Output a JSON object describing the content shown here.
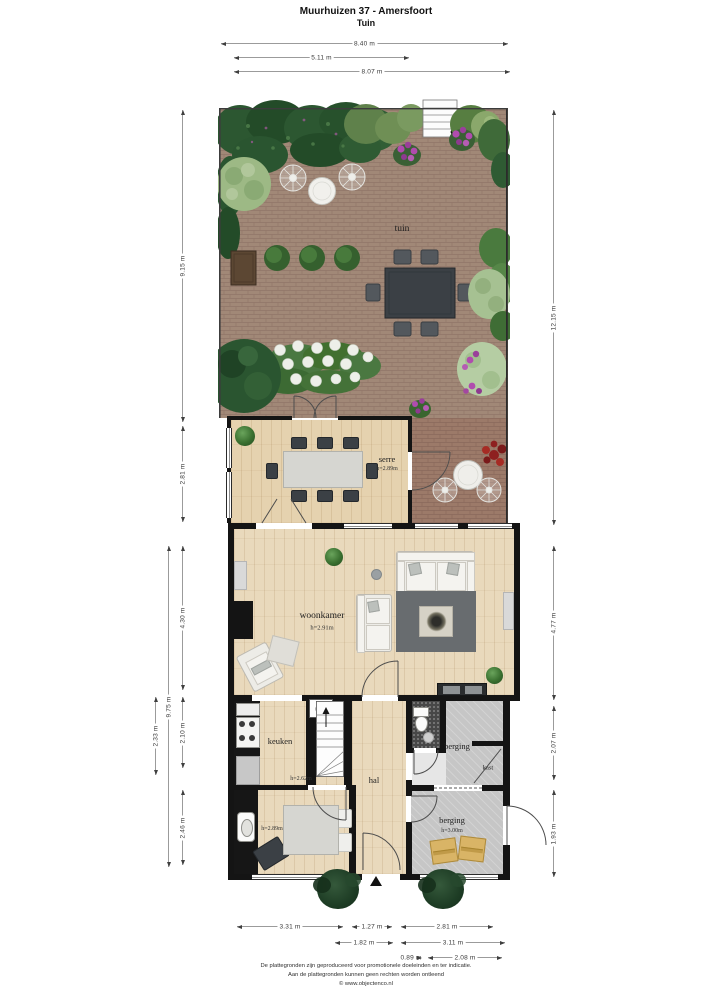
{
  "header": {
    "title": "Muurhuizen 37 - Amersfoort",
    "subtitle": "Tuin"
  },
  "dimensions": {
    "top": [
      "8.40 m",
      "5.11 m",
      "8.07 m"
    ],
    "left": [
      "9.15 m",
      "2.81 m",
      "9.75 m",
      "4.30 m",
      "2.33 m",
      "2.10 m",
      "2.46 m"
    ],
    "right": [
      "12.15 m",
      "4.77 m",
      "2.07 m",
      "1.93 m"
    ],
    "bottom": [
      "3.31 m",
      "1.27 m",
      "2.81 m",
      "1.82 m",
      "3.11 m",
      "0.89 m",
      "2.08 m"
    ]
  },
  "rooms": {
    "tuin": {
      "label": "tuin"
    },
    "serre": {
      "label": "serre",
      "height": "h=2.89m"
    },
    "woonkamer": {
      "label": "woonkamer",
      "height": "h=2.91m"
    },
    "keuken": {
      "label": "keuken",
      "height": "h=2.62m"
    },
    "hal": {
      "label": "hal"
    },
    "berging_boven": {
      "label": "berging"
    },
    "kast": {
      "label": "kast"
    },
    "berging_onder": {
      "label": "berging",
      "height": "h=3.00m"
    },
    "kamer": {
      "height": "h=2.89m"
    }
  },
  "footer": {
    "line1": "De plattegronden zijn geproduceerd voor promotionele doeleinden en ter indicatie.",
    "line2": "Aan de plattegronden kunnen geen rechten worden ontleend",
    "line3": "© www.objectenco.nl"
  },
  "colors": {
    "garden_paving": "#a18877",
    "patio_paving": "#9c7a69",
    "wood_floor": "#e9d9bc",
    "storage_floor": "#c6c6c6",
    "wall": "#141414",
    "bush_dark": "#2c5731",
    "bush_light": "#9db985",
    "flower_purple": "#b04cae",
    "flower_white": "#edefe9",
    "table_dark": "#3b4045",
    "accent_red": "#8e2020"
  }
}
